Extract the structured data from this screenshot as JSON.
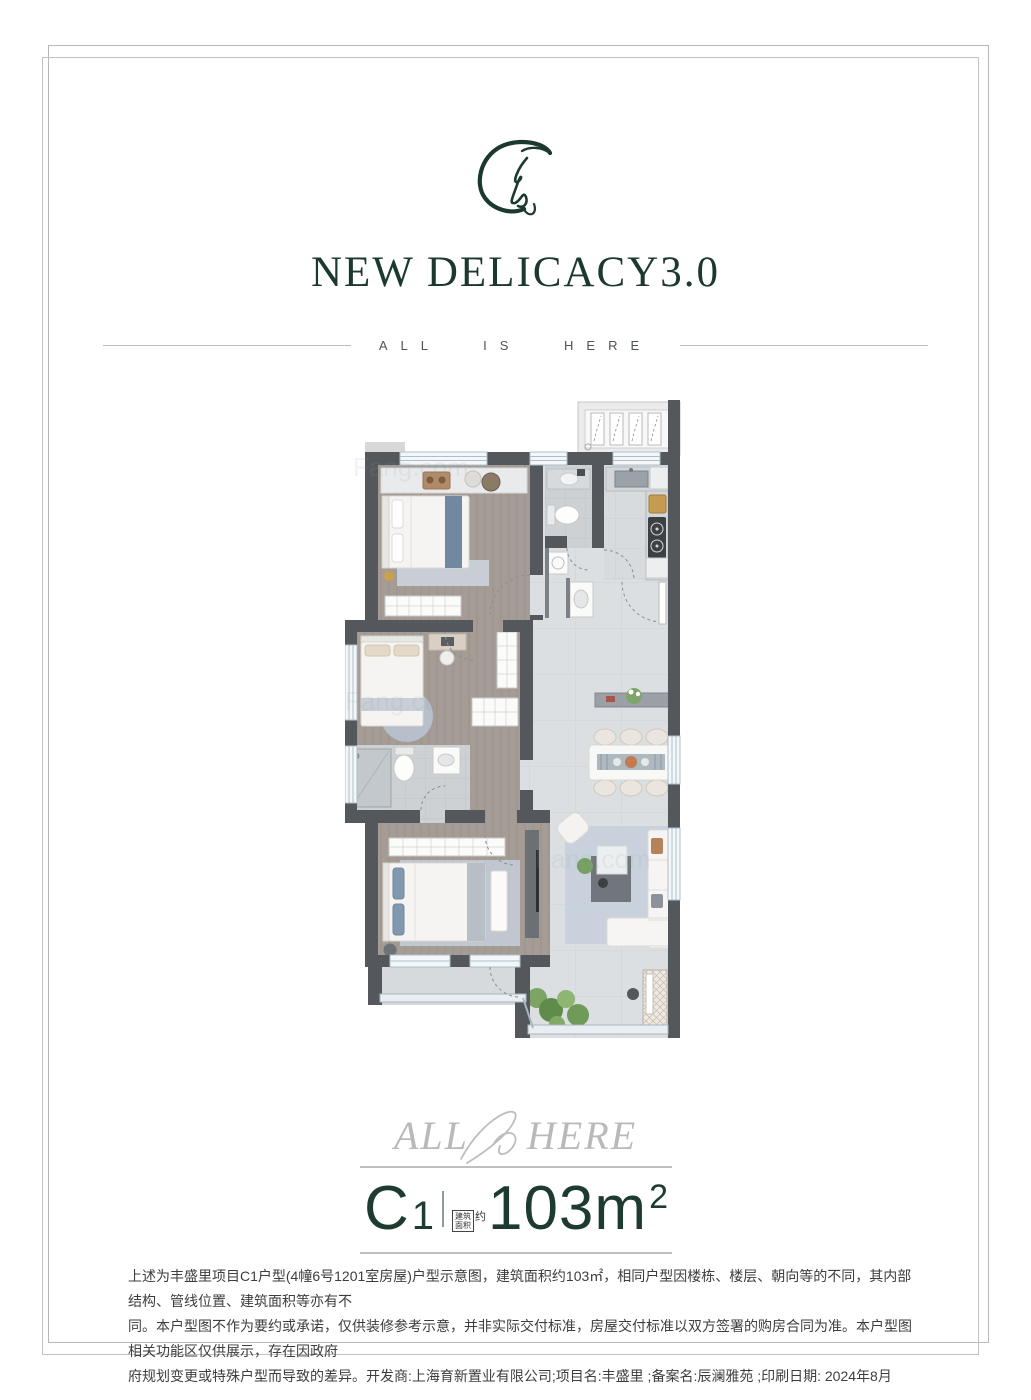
{
  "header": {
    "title": "NEW DELICACY3.0",
    "tagline": "ALL IS HERE"
  },
  "watermark": {
    "left": "ALL",
    "right": "HERE"
  },
  "spec": {
    "unit_letter": "C",
    "unit_digit": "1",
    "area_box_line1": "建筑",
    "area_box_line2": "面积",
    "area_prefix": "约",
    "area_value": "103m",
    "area_sup": "2"
  },
  "disclaimer": {
    "lines": [
      "上述为丰盛里项目C1户型(4幢6号1201室房屋)户型示意图，建筑面积约103㎡，相同户型因楼栋、楼层、朝向等的不同，其内部结构、管线位置、建筑面积等亦有不",
      "同。本户型图不作为要约或承诺，仅供装修参考示意，并非实际交付标准，房屋交付标准以双方签署的购房合同为准。本户型图相关功能区仅供展示，存在因政府",
      "府规划变更或特殊户型而导致的差异。开发商:上海育新置业有限公司;项目名:丰盛里 ;备案名:辰澜雅苑 ;印刷日期: 2024年8月"
    ]
  },
  "colors": {
    "accent_green": "#1c392e",
    "wall": "#54585d",
    "wood_floor": "#a59c95",
    "tile_floor": "#dcdfe1",
    "rug_blue": "#c5cfda"
  },
  "site_watermark": "Fang.com"
}
